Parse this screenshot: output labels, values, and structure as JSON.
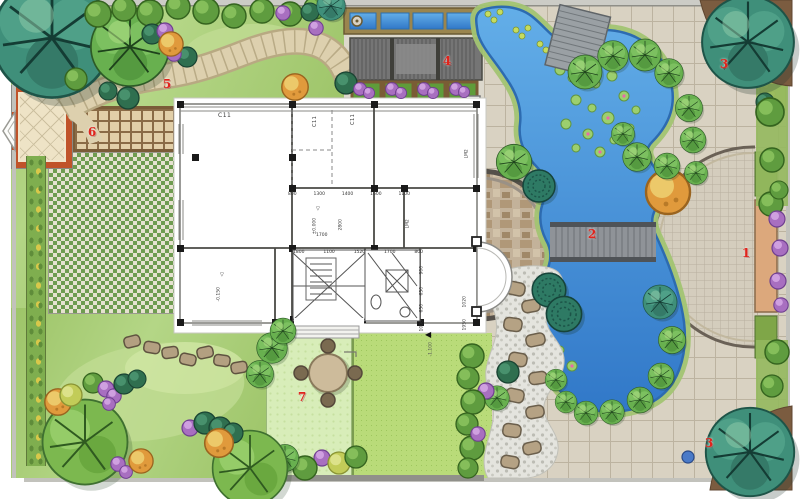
{
  "markers": {
    "area1": "1",
    "area2": "2",
    "area3_top": "3",
    "area3_bottom": "3",
    "area4": "4",
    "area5": "5",
    "area6": "6",
    "area7": "7"
  },
  "floorplan": {
    "window_label_1": "C11",
    "window_label_2": "C11",
    "window_label_3": "C11",
    "door_label_1": "LM2",
    "door_label_2": "LM2",
    "elevation_main": "±0.000",
    "elevation_room": "-0.150",
    "elevation_lawn": "-1.100",
    "dims_top": [
      "800",
      "1300",
      "1400",
      "1600",
      "1100"
    ],
    "dims_mid": [
      "1800",
      "1100",
      "1520",
      "1700",
      "800"
    ],
    "dims_right": [
      "900",
      "650",
      "650",
      "1000"
    ],
    "dim_width": "2800",
    "dim_inner": "1700",
    "dim_bay_1": "1020",
    "dim_bay_2": "1950"
  },
  "glyphs": {
    "elev_flag": "▽",
    "lawn_arrow": "◀"
  },
  "colors": {
    "marker_red": "#e0241c",
    "water_blue": "#4a94dc",
    "lawn_green": "#b9db79",
    "paving_tan": "#d9d2c2",
    "path_tan": "#ddd0ae",
    "tree_teal": "#3f8f7a",
    "tree_green": "#68b04f",
    "shrub_purple": "#a86fc0",
    "shrub_orange": "#e09a3c"
  }
}
